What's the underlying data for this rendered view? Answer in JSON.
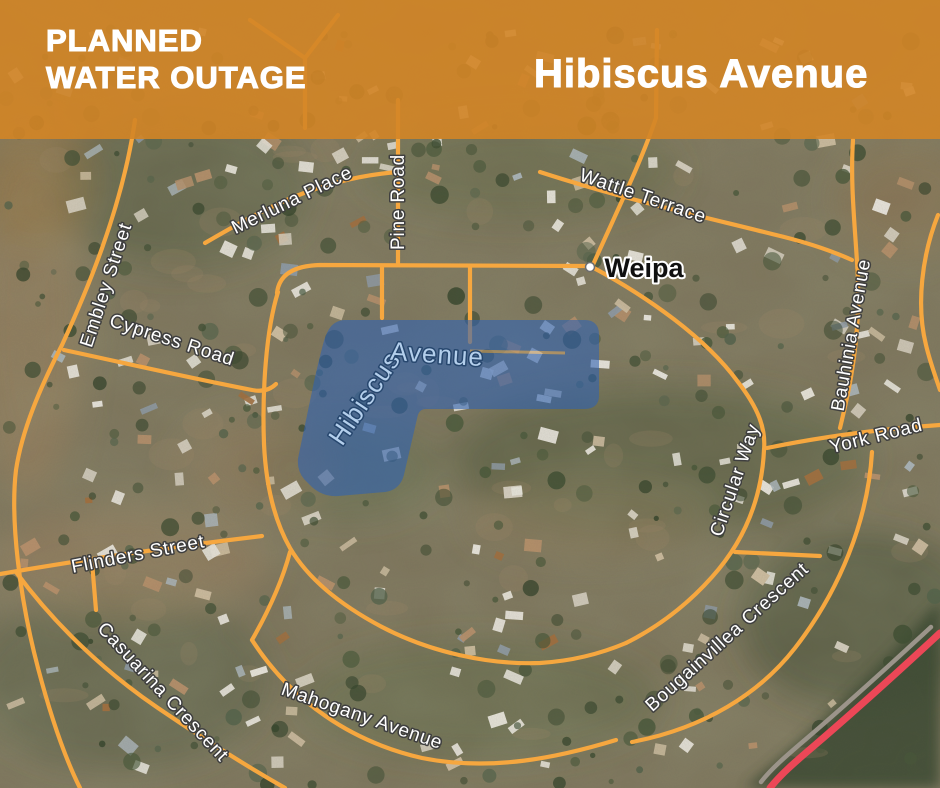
{
  "banner": {
    "heading_line1": "PLANNED",
    "heading_line2": "WATER OUTAGE",
    "location": "Hibiscus Avenue",
    "background_color": "#d38526",
    "text_color": "#ffffff"
  },
  "map": {
    "town_label": "Weipa",
    "outage_label_line1": "Hibiscus",
    "outage_label_line2": "Avenue",
    "outage_fill_color": "#2e62b5",
    "road_color": "#f6a73f",
    "highway_color": "#ec4757",
    "street_label_color": "#ffffff",
    "streets": [
      {
        "name": "Merluna Place"
      },
      {
        "name": "Pine Road"
      },
      {
        "name": "Wattle Terrace"
      },
      {
        "name": "Embley Street"
      },
      {
        "name": "Cypress Road"
      },
      {
        "name": "Bauhinia Avenue"
      },
      {
        "name": "York Road"
      },
      {
        "name": "Circular Way"
      },
      {
        "name": "Flinders Street"
      },
      {
        "name": "Casuarina Crescent"
      },
      {
        "name": "Mahogany Avenue"
      },
      {
        "name": "Bougainvillea Crescent"
      }
    ]
  }
}
